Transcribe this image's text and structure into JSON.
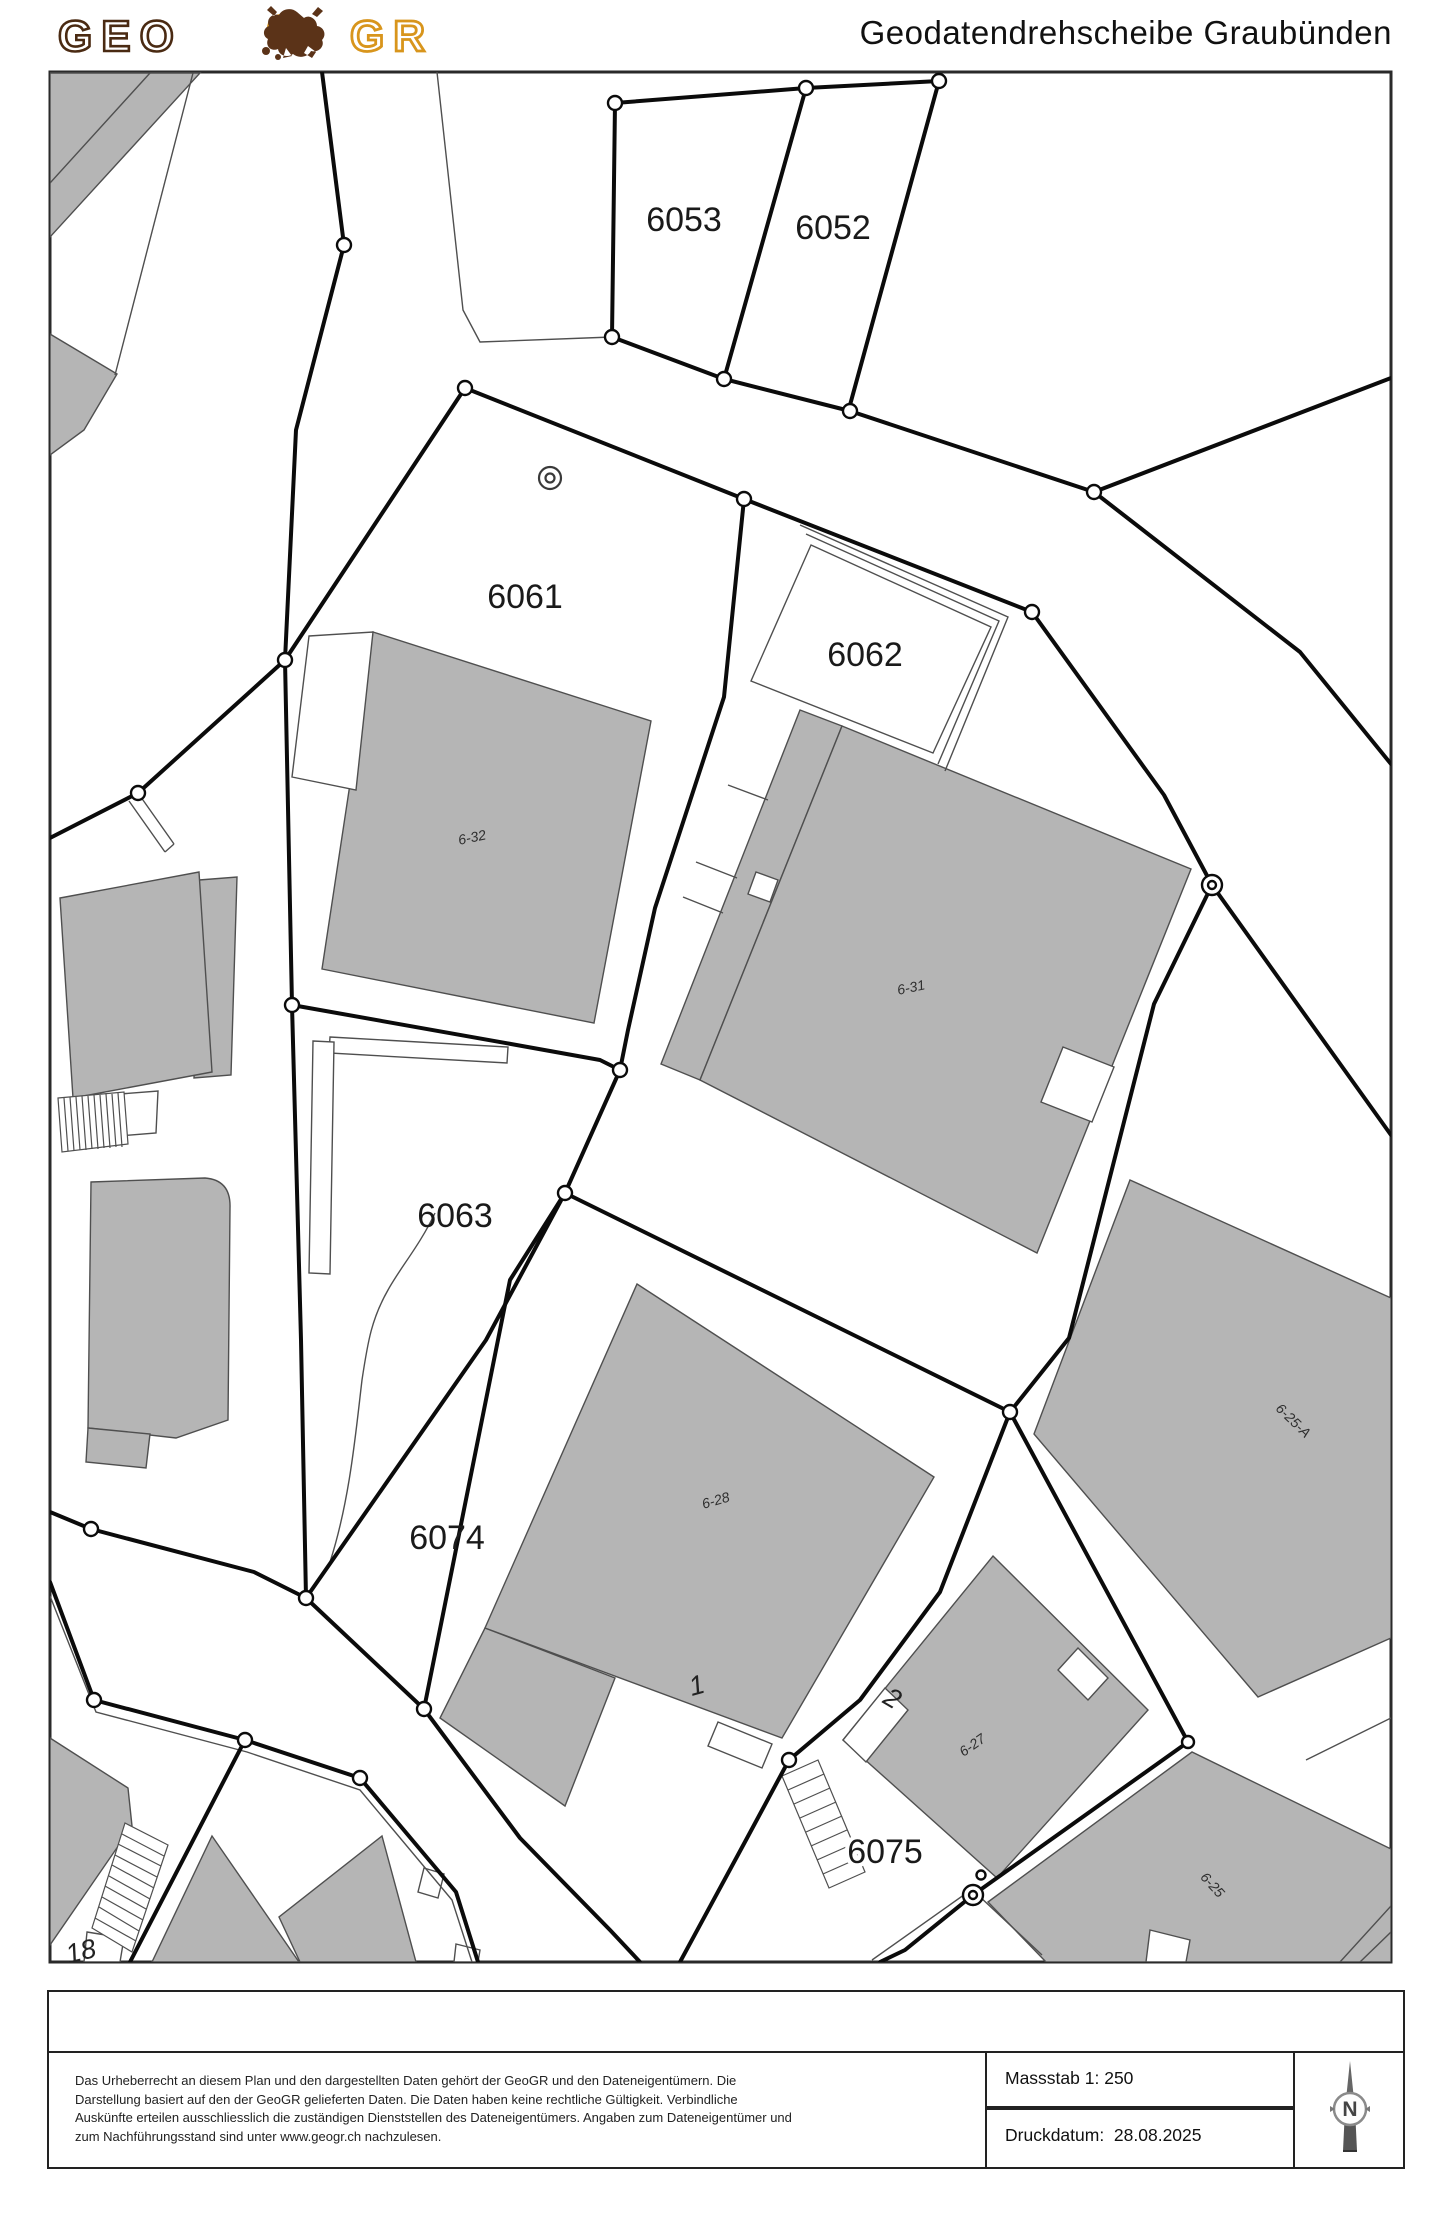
{
  "header": {
    "logo_geo": "GEO",
    "logo_gr": "GR",
    "title": "Geodatendrehscheibe Graubünden"
  },
  "map": {
    "colors": {
      "building_fill": "#b5b5b5",
      "boundary": "#0b0b0b",
      "thin_line": "#4f4f4f",
      "label": "#1a1a1a"
    },
    "parcel_labels": [
      {
        "text": "6053",
        "x": 684,
        "y": 231,
        "rot": 0,
        "halo": false
      },
      {
        "text": "6052",
        "x": 833,
        "y": 239,
        "rot": 0,
        "halo": false
      },
      {
        "text": "6061",
        "x": 525,
        "y": 608,
        "rot": 0,
        "halo": false
      },
      {
        "text": "6062",
        "x": 865,
        "y": 666,
        "rot": 0,
        "halo": false
      },
      {
        "text": "6063",
        "x": 455,
        "y": 1227,
        "rot": 0,
        "halo": false
      },
      {
        "text": "6074",
        "x": 447,
        "y": 1549,
        "rot": 0,
        "halo": false
      },
      {
        "text": "6075",
        "x": 885,
        "y": 1863,
        "rot": 0,
        "halo": true
      }
    ],
    "building_labels": [
      {
        "text": "6-32",
        "x": 473,
        "y": 842,
        "rot": -12
      },
      {
        "text": "6-31",
        "x": 912,
        "y": 992,
        "rot": -12
      },
      {
        "text": "6-28",
        "x": 717,
        "y": 1505,
        "rot": -16
      },
      {
        "text": "6-25-A",
        "x": 1290,
        "y": 1424,
        "rot": 44
      },
      {
        "text": "6-27",
        "x": 975,
        "y": 1749,
        "rot": -35
      },
      {
        "text": "6-25",
        "x": 1209,
        "y": 1888,
        "rot": 48
      }
    ],
    "house_numbers": [
      {
        "text": "1",
        "x": 699,
        "y": 1694,
        "rot": -15
      },
      {
        "text": "2",
        "x": 888,
        "y": 1706,
        "rot": 30
      },
      {
        "text": "18",
        "x": 83,
        "y": 1960,
        "rot": -14
      }
    ],
    "symbols": {
      "survey_point": {
        "x": 550,
        "y": 478
      }
    }
  },
  "footer": {
    "copyright_lines": [
      "Das Urheberrecht an diesem Plan und den dargestellten Daten gehört der GeoGR und den Dateneigentümern. Die",
      "Darstellung basiert auf den der GeoGR gelieferten Daten. Die Daten haben keine rechtliche Gültigkeit. Verbindliche",
      "Auskünfte erteilen ausschliesslich die zuständigen Dienststellen des Dateneigentümers. Angaben zum Dateneigentümer und",
      "zum Nachführungsstand sind unter www.geogr.ch nachzulesen."
    ],
    "scale_label": "Massstab 1: 250",
    "date_label": "Druckdatum:  28.08.2025",
    "compass_letter": "N"
  }
}
